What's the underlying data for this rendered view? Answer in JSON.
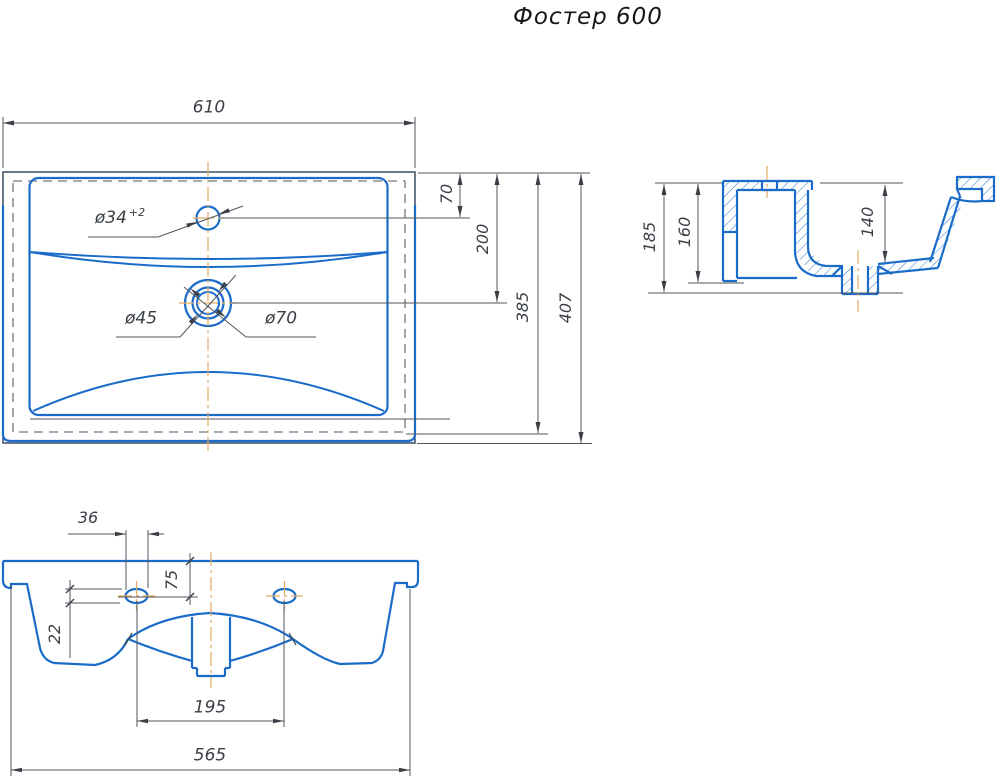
{
  "title": "Фостер 600",
  "colors": {
    "outline_blue": "#1b6cc8",
    "edge_dark": "#2e4059",
    "dimension_gray": "#51565e",
    "hidden_gray": "#73787f",
    "centerline_orange": "#e2a963"
  },
  "top_view": {
    "width": "610",
    "faucet_hole_offset": "70",
    "drain_offset": "200",
    "basin_depth": "385",
    "total_depth": "407",
    "faucet_hole_diameter": "ø34",
    "faucet_hole_tolerance": "+2",
    "drain_inner_diameter": "ø45",
    "drain_outer_diameter": "ø70"
  },
  "side_view": {
    "total_height": "185",
    "back_height": "160",
    "bowl_depth": "140"
  },
  "front_view": {
    "slot_width": "36",
    "hole_offset_from_top": "75",
    "slot_height": "22",
    "slot_spacing": "195",
    "bottom_width": "565"
  }
}
